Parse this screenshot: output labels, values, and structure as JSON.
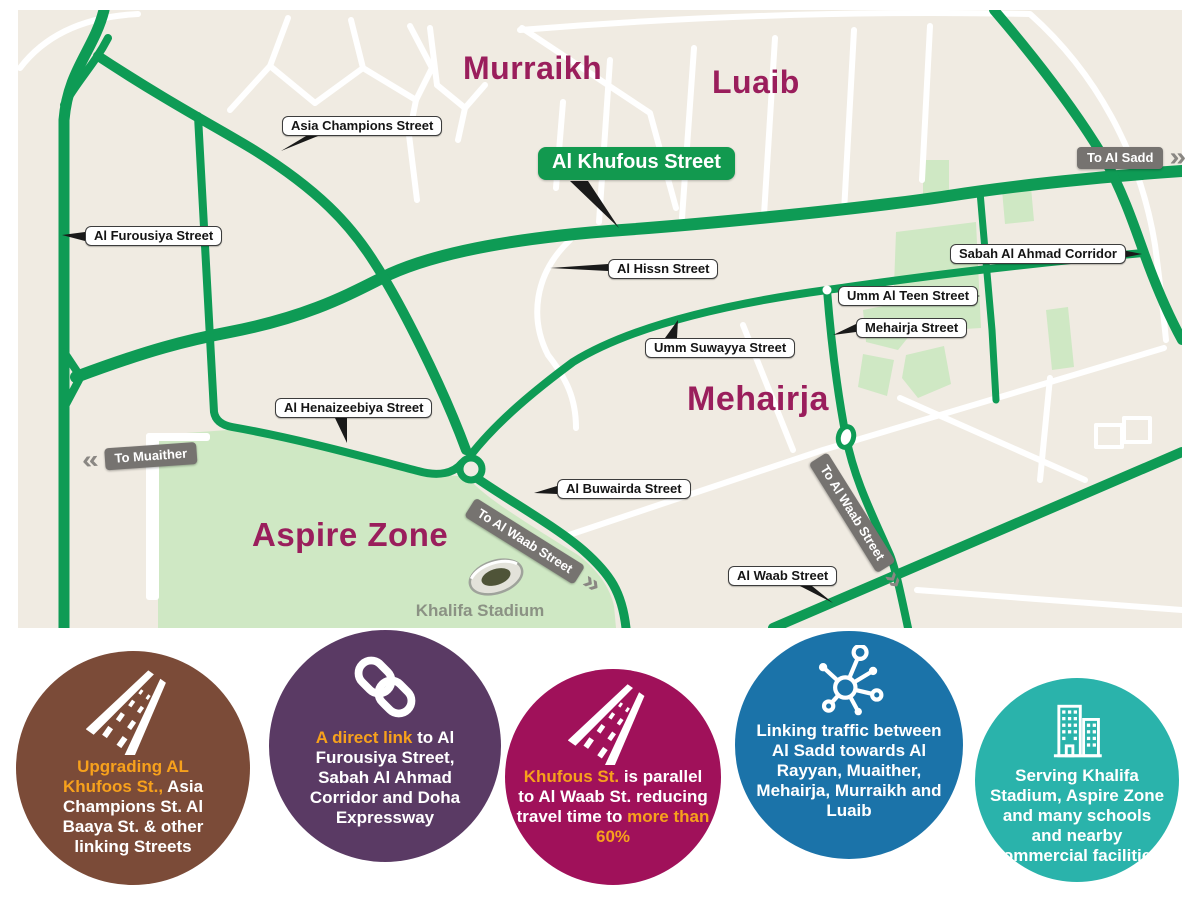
{
  "map": {
    "areas": [
      "Murraikh",
      "Luaib",
      "Mehairja",
      "Aspire Zone"
    ],
    "poi": "Khalifa Stadium",
    "highlight_label": "Al Khufous Street",
    "street_labels": [
      "Asia Champions Street",
      "Al Furousiya Street",
      "Al Hissn Street",
      "Sabah Al Ahmad Corridor",
      "Umm Al Teen Street",
      "Mehairja Street",
      "Umm Suwayya Street",
      "Al Henaizeebiya Street",
      "Al Buwairda Street",
      "Al Waab Street"
    ],
    "directions": {
      "sadd": "To Al Sadd",
      "muaither": "To Muaither",
      "waab1": "To Al Waab Street",
      "waab2": "To Al Waab Street"
    },
    "colors": {
      "background": "#F0EBE2",
      "road_green": "#0E9B55",
      "minor_road": "#FFFFFF",
      "zone_green": "#CFE8C4",
      "area_text": "#9A1E5C",
      "direction_bg": "#767370",
      "highlight_bg": "#12994F"
    }
  },
  "badges": [
    {
      "icon": "road-icon",
      "color": "#7B4B38",
      "hl1": "Upgrading AL Khufoos St.,",
      "normal": " Asia Champions St. Al Baaya St. & other linking Streets",
      "hl2": ""
    },
    {
      "icon": "link-icon",
      "color": "#5A3A64",
      "hl1": "A direct link",
      "normal": " to Al Furousiya Street, Sabah Al Ahmad Corridor and Doha Expressway",
      "hl2": ""
    },
    {
      "icon": "road-icon",
      "color": "#A0115A",
      "hl1": "Khufous St.",
      "normal": " is parallel to Al Waab St. reducing travel time to ",
      "hl2": "more than 60%"
    },
    {
      "icon": "network-icon",
      "color": "#1B73A9",
      "hl1": "",
      "normal": "Linking traffic between Al Sadd towards Al Rayyan, Muaither, Mehairja, Murraikh and Luaib",
      "hl2": ""
    },
    {
      "icon": "buildings-icon",
      "color": "#2AB3AB",
      "hl1": "",
      "normal": "Serving Khalifa Stadium, Aspire Zone and many schools and nearby commercial facilities",
      "hl2": ""
    }
  ],
  "accent_orange": "#F7A11C"
}
